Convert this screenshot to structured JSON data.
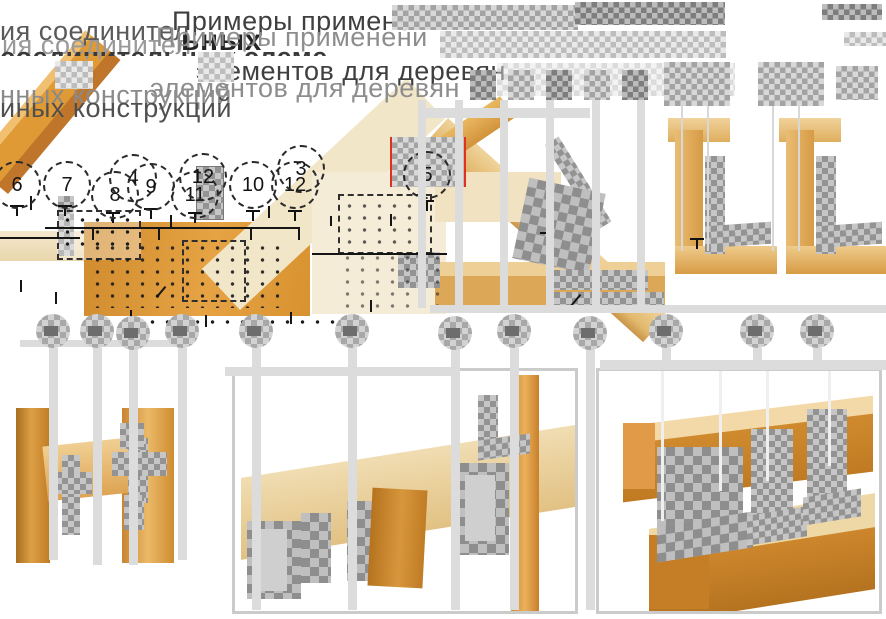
{
  "title": {
    "full_text": "Примеры применения соединительных элементов для деревянных конструкций",
    "center_line1": "Примеры применени",
    "center_line1_ghost": "Примеры применени",
    "center_line2": "элементов для деревян",
    "center_line2_ghost": "элементов для деревян",
    "left_line1": "ия соединител",
    "left_line1_ghost": "ия соединител",
    "left_word_bold": "ьных",
    "left_clip_strip": "соединительных элеме",
    "left_line2": "нных конструкций",
    "left_line2_ghost": "иных конструкций"
  },
  "callouts": {
    "list": [
      {
        "label": "6"
      },
      {
        "label": "7"
      },
      {
        "label": "8"
      },
      {
        "label": "4"
      },
      {
        "label": "9"
      },
      {
        "label": "11"
      },
      {
        "label": "12"
      },
      {
        "label": "10"
      },
      {
        "label": "12"
      },
      {
        "label": "3"
      },
      {
        "label": "5"
      }
    ]
  },
  "colors": {
    "wood_dark": "#c9802a",
    "wood_mid": "#e0993a",
    "wood_light": "#ecca8e",
    "wood_pale": "#f3e7cb",
    "metal_dark": "#8e8e8e",
    "metal_light": "#c6c6c6",
    "leader_grey": "#dcdcdc",
    "panel_border": "#cbcbcb",
    "red_edge": "#e03020",
    "text_dark": "#3f3f3f",
    "text_ghost": "#9a9a9a"
  }
}
